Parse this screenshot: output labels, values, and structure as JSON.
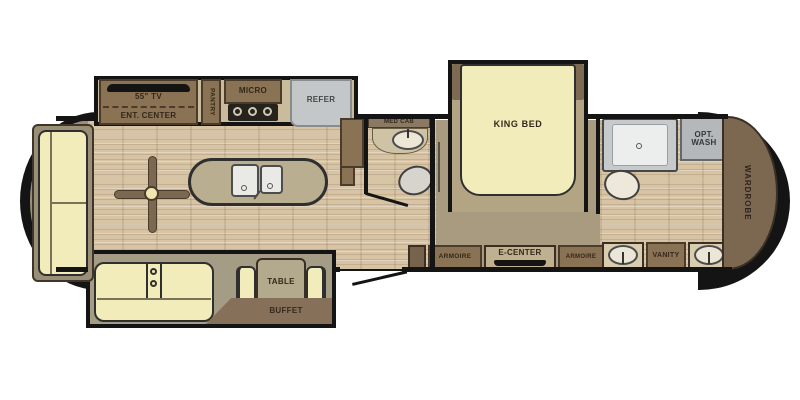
{
  "plan_type": "fifth-wheel RV floor plan",
  "labels": {
    "tv": "55\" TV",
    "ent_center": "ENT. CENTER",
    "pantry": "PANTRY",
    "micro": "MICRO",
    "refer": "REFER",
    "med_cab": "MED CAB",
    "king_bed": "KING BED",
    "opt_wash": "OPT. WASH",
    "wardrobe": "WARDROBE",
    "armoire_front": "ARMOIRE",
    "e_center": "E-CENTER",
    "armoire_rear": "ARMOIRE",
    "vanity": "VANITY",
    "table": "TABLE",
    "buffet": "BUFFET"
  },
  "colors": {
    "hull_outline": "#141414",
    "wood_floor": "#d7c4a5",
    "carpet": "#a89b80",
    "cabinet_brown": "#8a7254",
    "cabinet_dark": "#77624c",
    "counter_tan": "#bfb090",
    "furniture_yellow": "#f2ecba",
    "appliance_gray": "#c3c7c8"
  }
}
